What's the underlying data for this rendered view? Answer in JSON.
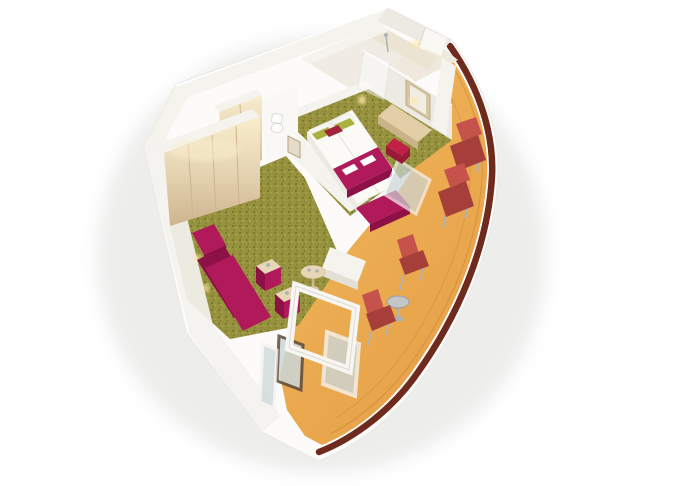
{
  "scene": {
    "type": "3d-cutaway-floorplan",
    "subject": "balcony cabin suite rendering",
    "view": "isometric-aerial"
  },
  "rooms": [
    {
      "id": "entry",
      "label": "entry"
    },
    {
      "id": "bathroom",
      "label": "bathroom"
    },
    {
      "id": "wc",
      "label": "wc"
    },
    {
      "id": "bedroom",
      "label": "bedroom"
    },
    {
      "id": "wardrobe",
      "label": "wardrobe"
    },
    {
      "id": "living-room",
      "label": "living room"
    },
    {
      "id": "balcony",
      "label": "balcony"
    }
  ],
  "furniture": [
    "twin-beds",
    "bed-runner",
    "pillows",
    "towels",
    "bed-bench",
    "bedside-lamp",
    "vanity-desk",
    "vanity-mirror",
    "desk-stool",
    "wardrobe-closet",
    "entry-closet",
    "toilet",
    "shower",
    "corner-sofa",
    "ottoman",
    "cube-side-table-1",
    "cube-side-table-2",
    "round-coffee-table",
    "sun-lounger-1",
    "sun-lounger-2",
    "deck-chair-1",
    "deck-chair-2",
    "bistro-table",
    "sliding-glass-doors",
    "picture-frame"
  ],
  "colors": {
    "background": "#ffffff",
    "shadow": "#dfdfdd",
    "wall_light": "#f5f3ee",
    "wall_mid": "#eceae3",
    "wall_dark": "#dbd7cf",
    "wood": "#e8d7b6",
    "wood_dark": "#cdb58e",
    "wood_glow": "#f9eecd",
    "carpet": "#96923d",
    "carpet_dark": "#75712c",
    "carpet_light": "#a9a54d",
    "magenta": "#b0195a",
    "magenta_dark": "#8d1147",
    "crimson": "#c22147",
    "crimson_dark": "#981a39",
    "red": "#c5534c",
    "red_dark": "#a63f39",
    "deck": "#e6a047",
    "deck_light": "#f2b95e",
    "deck_dark": "#c77f34",
    "hull": "#6f2a1e",
    "glass": "#ccd6d8",
    "metal": "#aeb3b5",
    "bed": "#fbfaf7",
    "pillow_green": "#a9b23f",
    "pillow_red": "#a2243b",
    "glow": "#ffe9a8",
    "bath_wall": "#ece4d2"
  }
}
